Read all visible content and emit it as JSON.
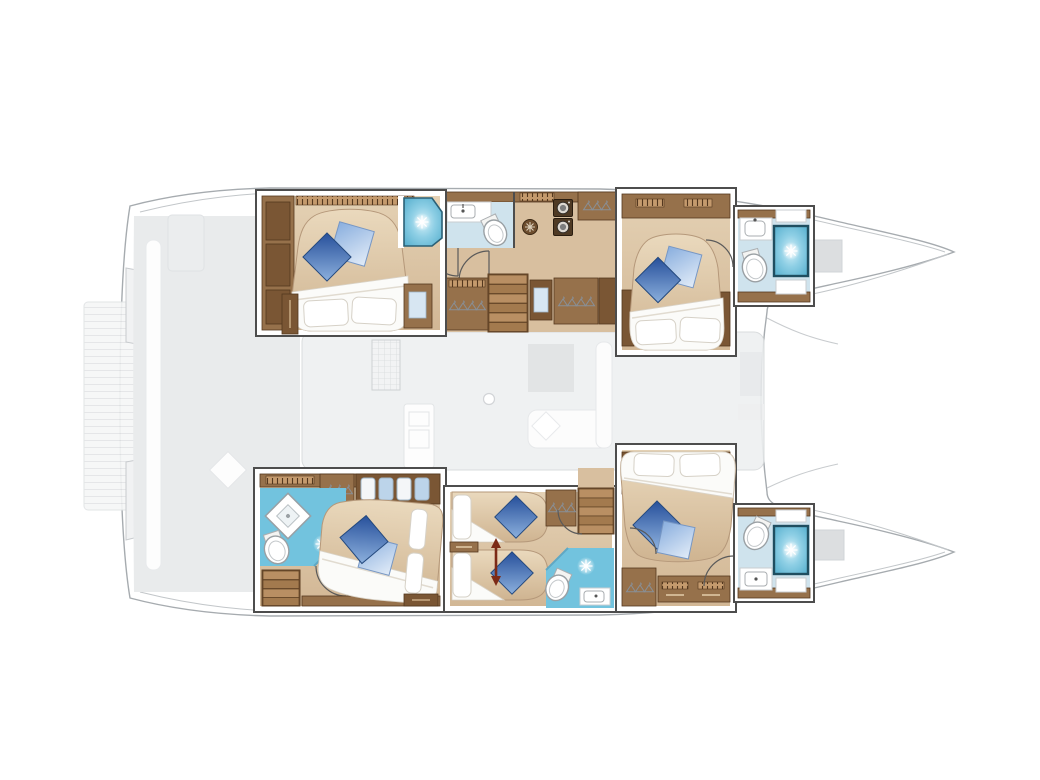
{
  "diagram": {
    "title": "Catamaran yacht lower-deck floor plan",
    "orientation": {
      "bow": "right",
      "stern": "left"
    },
    "counts": {
      "double_cabins": 4,
      "single_berths": 2,
      "bathrooms": 5,
      "stair_flights": 3
    }
  },
  "colors": {
    "tan_floor": "#d8bf9f",
    "tan_floor_light": "#e4d1b4",
    "wood_mid": "#96714b",
    "wood_dark": "#7a5634",
    "wood_deep": "#54381f",
    "wood_trim": "#b08c63",
    "wall": "#4d4d4d",
    "hull_stroke": "#a6abaf",
    "bath_floor": "#cfe3ed",
    "bath_floor_bright": "#72c3de",
    "shower_frame": "#225d73",
    "glass": "#5fa8c4",
    "duvet": "#fbfbf9",
    "mattress": "#d9c2a2",
    "pillow_dark_blue": "#27509b",
    "pillow_light_blue": "#89aede",
    "ghost_fill": "#f0f1f2",
    "ghost_stroke": "#c2c6c9",
    "arrow_red": "#7c2a16"
  },
  "rooms": [
    {
      "id": "port-aft-cabin",
      "type": "double-cabin",
      "bed": "island double bed",
      "cushions": [
        "dark-blue-diamond",
        "light-blue-square"
      ],
      "features": [
        "wardrobe",
        "nightstands",
        "corner-shower"
      ]
    },
    {
      "id": "port-midship-bathroom",
      "type": "bathroom",
      "fixtures": [
        "shower",
        "washbasin",
        "toilet"
      ]
    },
    {
      "id": "port-companionway",
      "type": "corridor",
      "features": [
        "washer-dryer-stack",
        "vent-rosette",
        "hanging-lockers",
        "stairs",
        "wardrobes"
      ]
    },
    {
      "id": "port-forward-cabin",
      "type": "double-cabin",
      "bed": "island double bed",
      "cushions": [
        "dark-blue-diamond",
        "light-blue-square"
      ]
    },
    {
      "id": "port-forward-bathroom",
      "type": "bathroom",
      "fixtures": [
        "washbasin",
        "toilet",
        "shower"
      ]
    },
    {
      "id": "starboard-aft-cabin",
      "type": "double-cabin",
      "bed": "island double bed",
      "features": [
        "ensuite-bathroom",
        "shower-tray",
        "toilet",
        "stairs",
        "hanging-locker",
        "towel-shelf"
      ]
    },
    {
      "id": "starboard-mid-cabin",
      "type": "twin-cabin",
      "beds": 2,
      "features": [
        "ensuite-bathroom",
        "stairs",
        "hanging-locker",
        "direction-arrow"
      ]
    },
    {
      "id": "starboard-forward-cabin",
      "type": "double-cabin",
      "bed": "island double bed",
      "features": [
        "hanging-locker",
        "drawer-bank"
      ]
    },
    {
      "id": "starboard-forward-bathroom",
      "type": "bathroom",
      "fixtures": [
        "toilet",
        "shower",
        "washbasin"
      ]
    },
    {
      "id": "saloon",
      "type": "ghosted-bridgedeck",
      "features": [
        "galley-island",
        "chart-table",
        "sofa",
        "mast-step"
      ]
    },
    {
      "id": "cockpit",
      "type": "ghosted-aft-deck",
      "features": [
        "bench",
        "table",
        "deck-cushions"
      ]
    },
    {
      "id": "swim-platform",
      "type": "ghosted-platform",
      "features": [
        "plank-deck"
      ]
    },
    {
      "id": "foredeck",
      "type": "ghosted-foredeck",
      "features": [
        "trampoline",
        "sunpad-blocks"
      ]
    }
  ],
  "icons": [
    "shower-sparkle-icon",
    "clothes-hanger-icon",
    "washer-dryer-icon",
    "vent-rosette-icon",
    "toilet-icon",
    "sink-icon",
    "door-swing-icon",
    "stairs-icon",
    "double-arrow-icon",
    "mast-step-icon"
  ]
}
